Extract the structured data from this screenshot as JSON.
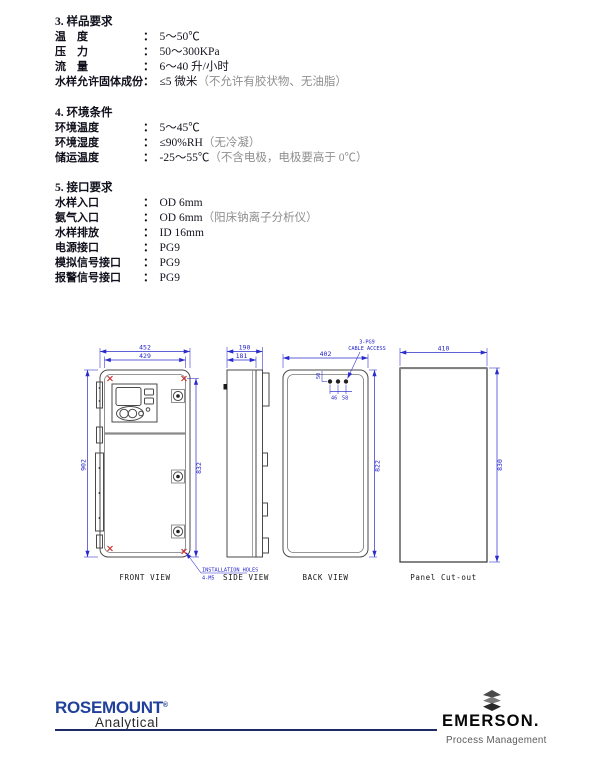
{
  "doc": {
    "colon": "：",
    "sections": [
      {
        "heading": "3. 样品要求",
        "rows": [
          {
            "label": "温　度",
            "value": "5～50℃",
            "note": ""
          },
          {
            "label": "压　力",
            "value": "50～300KPa",
            "note": ""
          },
          {
            "label": "流　量",
            "value": "6～40 升/小时",
            "note": ""
          },
          {
            "label": "水样允许固体成份",
            "value": "≤5 微米",
            "note": "（不允许有胶状物、无油脂）"
          }
        ]
      },
      {
        "heading": "4. 环境条件",
        "rows": [
          {
            "label": "环境温度",
            "value": "5～45℃",
            "note": ""
          },
          {
            "label": "环境湿度",
            "value": "≤90%RH",
            "note": "（无冷凝）"
          },
          {
            "label": "储运温度",
            "value": "-25～55℃",
            "note": "（不含电极，电极要高于 0℃）"
          }
        ]
      },
      {
        "heading": "5. 接口要求",
        "rows": [
          {
            "label": "水样入口",
            "value": "OD 6mm",
            "note": ""
          },
          {
            "label": "氨气入口",
            "value": "OD 6mm",
            "note": "（阳床钠离子分析仪）"
          },
          {
            "label": "水样排放",
            "value": "ID 16mm",
            "note": ""
          },
          {
            "label": "电源接口",
            "value": "PG9",
            "note": ""
          },
          {
            "label": "模拟信号接口",
            "value": "PG9",
            "note": ""
          },
          {
            "label": "报警信号接口",
            "value": "PG9",
            "note": ""
          }
        ]
      }
    ]
  },
  "drawing": {
    "front": {
      "label": "FRONT VIEW",
      "dim_outer_width": "452",
      "dim_inner_width": "429",
      "dim_height_left": "902",
      "dim_height_right": "832",
      "leader_line1": "INSTALLATION HOLES",
      "leader_line2": "4-M5"
    },
    "side": {
      "label": "SIDE VIEW",
      "dim_depth_outer": "190",
      "dim_depth_inner": "181"
    },
    "back": {
      "label": "BACK VIEW",
      "dim_width": "402",
      "dim_height": "822",
      "dim_hole_offset": "50",
      "dim_hole_gap1": "46",
      "dim_hole_gap2": "58",
      "leader_line1": "3-PG9",
      "leader_line2": "CABLE ACCESS"
    },
    "cutout": {
      "label": "Panel Cut-out",
      "dim_width": "410",
      "dim_height": "830"
    }
  },
  "footer": {
    "rosemount": {
      "brand": "ROSEMOUNT",
      "reg": "®",
      "sub": "Analytical"
    },
    "emerson": {
      "brand": "EMERSON.",
      "sub": "Process Management"
    }
  },
  "colors": {
    "rosemount_blue": "#20409a",
    "dimension_blue": "#2424cc",
    "mark_red": "#cc2222"
  }
}
